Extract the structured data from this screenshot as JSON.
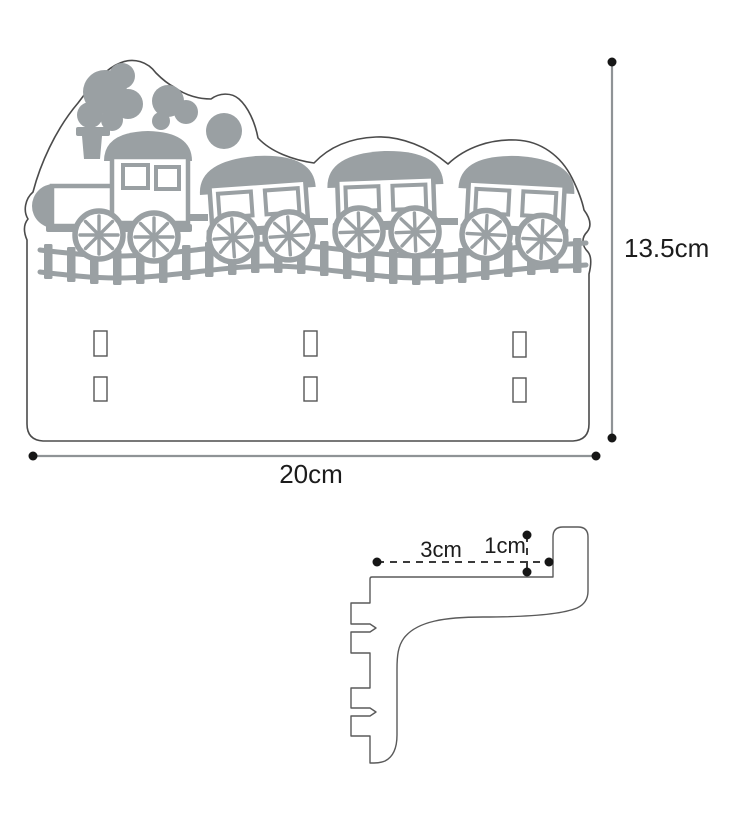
{
  "diagram": {
    "front_view": {
      "height_label": "13.5cm",
      "width_label": "20cm"
    },
    "profile_view": {
      "depth_label": "3cm",
      "gap_label": "1cm"
    }
  },
  "colors": {
    "paper": "#ffffff",
    "outline": "#4b4b4b",
    "train_gray": "#9aa0a3",
    "dim_line": "#8f9396",
    "dash_line": "#3a3a3a",
    "dot": "#161616",
    "text": "#1c1c1c"
  }
}
